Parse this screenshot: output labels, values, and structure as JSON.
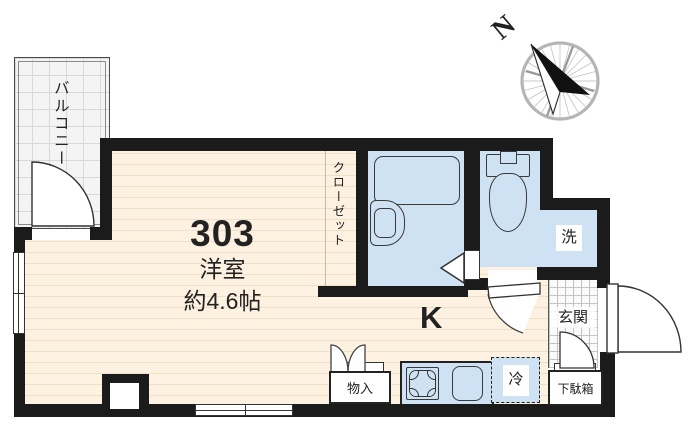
{
  "floorplan": {
    "unit": {
      "number": "303",
      "type": "洋室",
      "size": "約4.6帖"
    },
    "rooms": {
      "balcony": "バルコニー",
      "closet": "クローゼット",
      "kitchen": "K",
      "wash": "洗",
      "entrance": "玄関",
      "storage": "物入",
      "refrigerator": "冷",
      "shoe_cabinet": "下駄箱"
    },
    "compass": {
      "north": "N"
    },
    "colors": {
      "wall": "#1b1b1b",
      "floor": "#fdf2e1",
      "floor_line": "#efe0c8",
      "sanitary_blue": "#cfe2f3",
      "balcony_fill": "#f4f4f4"
    }
  }
}
